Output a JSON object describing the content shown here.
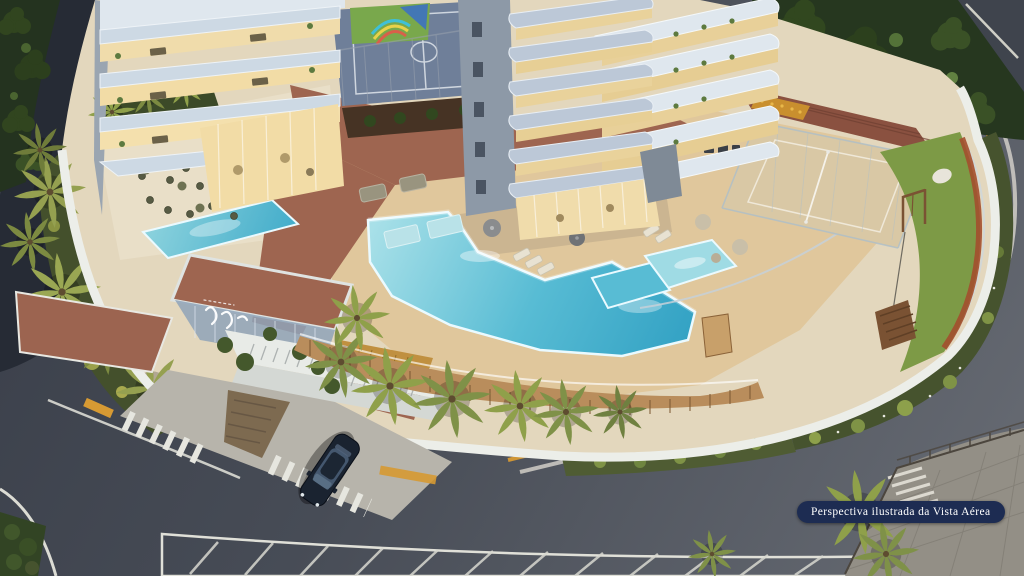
{
  "caption": {
    "text": "Perspectiva ilustrada da Vista Aérea"
  },
  "palette": {
    "asphalt": "#4a4e58",
    "asphalt_dark": "#262b35",
    "marking_white": "#e6e6df",
    "curb_yellow": "#d79a33",
    "wall_white": "#eceee9",
    "podium_base": "#e3d7bd",
    "terracotta": "#9e6550",
    "roof_brown": "#8a5140",
    "louver_gold": "#c09040",
    "deck_wood": "#e0c79c",
    "slat_wood": "#b98d5c",
    "pool_light": "#9fdbe4",
    "pool_mid": "#58bcd4",
    "sand": "#d9c8a5",
    "court_blue": "#6f7f99",
    "court_line": "#cfd6df",
    "mural_green": "#79a84c",
    "lawn": "#7d9a46",
    "hedge_orange": "#a34f2e",
    "garden_dark": "#46532e",
    "palm_green": "#8fa04a",
    "tree_dark": "#26371f",
    "tower_slab": "#bcc8d7",
    "tower_wall": "#8d99a7",
    "balcony_white": "#dfe7ee",
    "window_warm": "#f0dcab",
    "cabana_teal": "#64aebc",
    "car_dark": "#1a2330",
    "badge_navy": "#1d2c52",
    "badge_text": "#ffffff"
  },
  "scene": {
    "kind": "aerial-architectural-rendering-dusk",
    "elements": "residential tower, balcony wings, multisport court, beach tennis court, pools, wood deck, terracotta promenade, entrance canopy, driveway with crosswalks, playground lawn, curved perimeter wall, streets, sidewalk plaza, SUV"
  }
}
